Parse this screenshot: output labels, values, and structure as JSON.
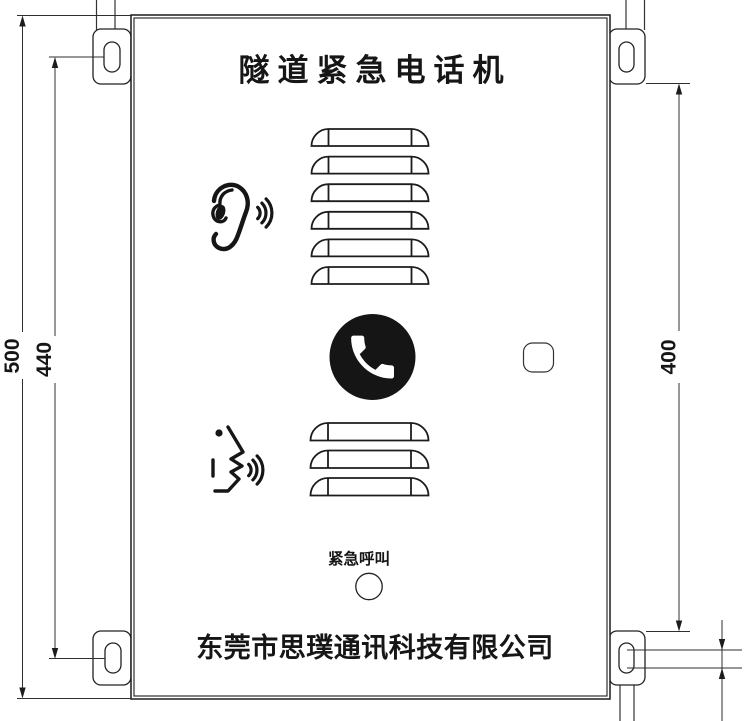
{
  "drawing": {
    "title": "隧道紧急电话机",
    "emergency_call_label": "紧急呼叫",
    "company_name": "东莞市思璞通讯科技有限公司",
    "dimensions": {
      "overall_height": "500",
      "left_hole_spacing": "440",
      "right_hole_spacing": "400"
    },
    "grilles": {
      "top": {
        "slat_count": 6
      },
      "bottom": {
        "slat_count": 3
      }
    },
    "colors": {
      "line": "#1c1c1c",
      "dimension_line": "#2f2f2f",
      "call_button_fill": "#151515",
      "background": "#ffffff"
    }
  }
}
